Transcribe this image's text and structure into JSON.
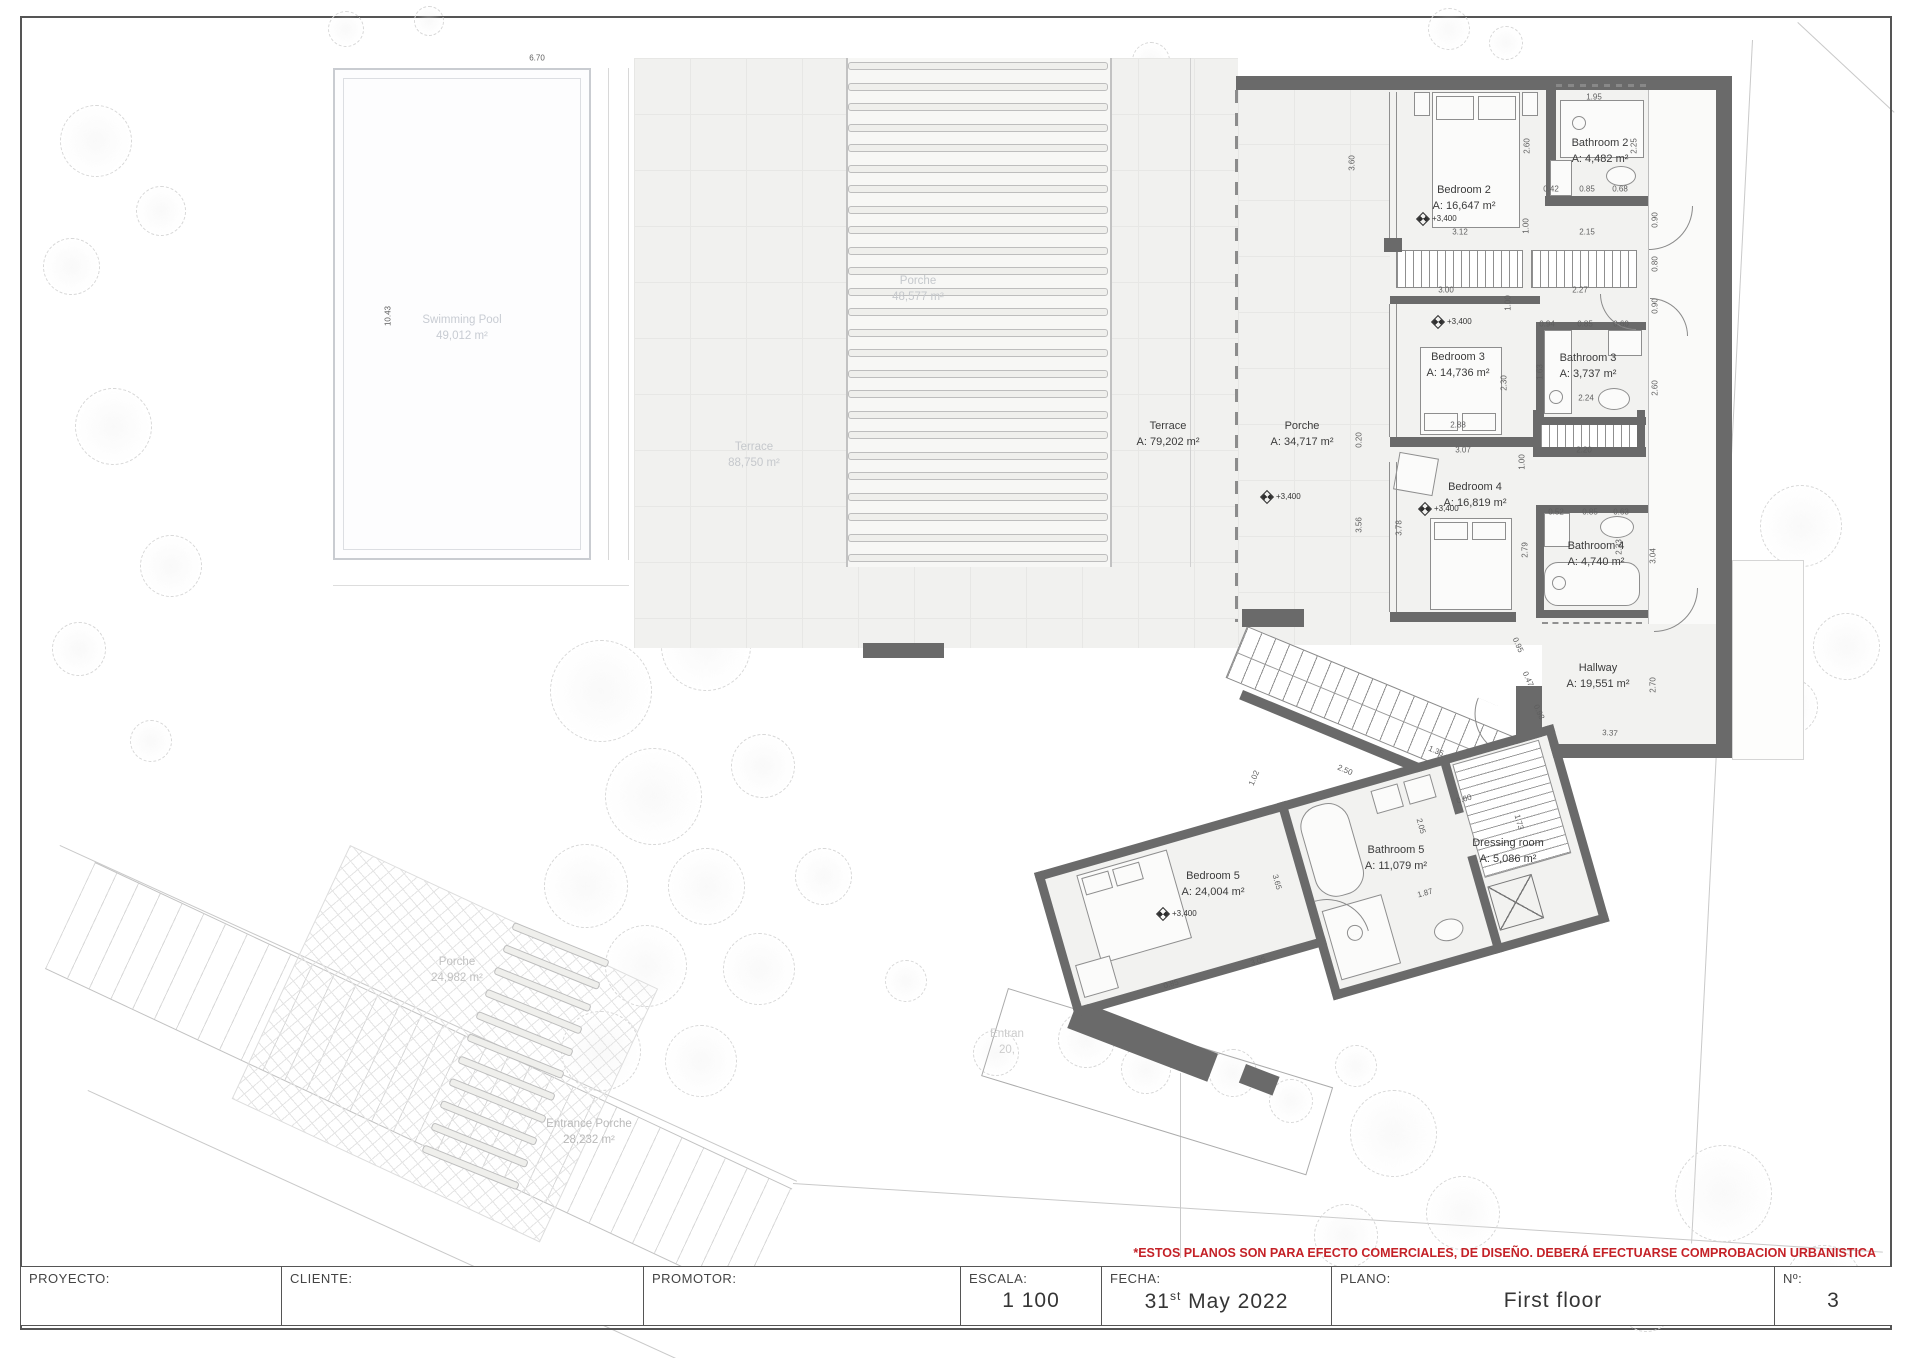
{
  "labels": {
    "plan": [
      {
        "name": "Bedroom 2",
        "area": "A: 16,647 m²"
      },
      {
        "name": "Bathroom 2",
        "area": "A: 4,482 m²"
      },
      {
        "name": "Bedroom 3",
        "area": "A: 14,736 m²"
      },
      {
        "name": "Bathroom 3",
        "area": "A: 3,737 m²"
      },
      {
        "name": "Bedroom 4",
        "area": "A: 16,819 m²"
      },
      {
        "name": "Bathroom 4",
        "area": "A: 4,740 m²"
      },
      {
        "name": "Hallway",
        "area": "A: 19,551 m²"
      },
      {
        "name": "Bedroom 5",
        "area": "A: 24,004 m²"
      },
      {
        "name": "Bathroom 5",
        "area": "A: 11,079 m²"
      },
      {
        "name": "Dressing room",
        "area": "A: 5,086 m²"
      },
      {
        "name": "Terrace",
        "area": "A: 79,202 m²"
      },
      {
        "name": "Porche",
        "area": "A: 34,717 m²"
      }
    ],
    "site": [
      {
        "name": "Swimming Pool",
        "area": "49,012 m²"
      },
      {
        "name": "Terrace",
        "area": "88,750 m²"
      },
      {
        "name": "Porche",
        "area": "48,577 m²"
      },
      {
        "name": "Entrance Porche",
        "area": "28,232 m²"
      },
      {
        "name": "Porche",
        "area": "24,982 m²"
      },
      {
        "name": "Entran",
        "area": "20,"
      }
    ]
  },
  "level_marker": {
    "text": "+3,400",
    "positions": [
      {
        "x": 1418,
        "y": 215
      },
      {
        "x": 1433,
        "y": 318
      },
      {
        "x": 1420,
        "y": 505
      },
      {
        "x": 1262,
        "y": 493
      },
      {
        "x": 1158,
        "y": 910
      }
    ]
  },
  "dims": [
    {
      "t": "6.70",
      "x": 537,
      "y": 58,
      "r": 0
    },
    {
      "t": "10.43",
      "x": 388,
      "y": 316,
      "r": -90
    },
    {
      "t": "3.60",
      "x": 1352,
      "y": 163,
      "r": -90
    },
    {
      "t": "1.95",
      "x": 1594,
      "y": 97,
      "r": 0
    },
    {
      "t": "2.60",
      "x": 1527,
      "y": 146,
      "r": -90
    },
    {
      "t": "2.25",
      "x": 1634,
      "y": 146,
      "r": -90
    },
    {
      "t": "0.42",
      "x": 1551,
      "y": 189,
      "r": 0
    },
    {
      "t": "0.85",
      "x": 1587,
      "y": 189,
      "r": 0
    },
    {
      "t": "0.68",
      "x": 1620,
      "y": 189,
      "r": 0
    },
    {
      "t": "1.00",
      "x": 1526,
      "y": 226,
      "r": -90
    },
    {
      "t": "3.12",
      "x": 1460,
      "y": 232,
      "r": 0
    },
    {
      "t": "2.15",
      "x": 1587,
      "y": 232,
      "r": 0
    },
    {
      "t": "0.90",
      "x": 1655,
      "y": 220,
      "r": -90
    },
    {
      "t": "0.80",
      "x": 1655,
      "y": 264,
      "r": -90
    },
    {
      "t": "3.00",
      "x": 1446,
      "y": 290,
      "r": 0
    },
    {
      "t": "2.27",
      "x": 1580,
      "y": 290,
      "r": 0
    },
    {
      "t": "1.00",
      "x": 1508,
      "y": 303,
      "r": -90
    },
    {
      "t": "0.94",
      "x": 1547,
      "y": 324,
      "r": 0
    },
    {
      "t": "0.85",
      "x": 1585,
      "y": 324,
      "r": 0
    },
    {
      "t": "0.60",
      "x": 1621,
      "y": 324,
      "r": 0
    },
    {
      "t": "1.63",
      "x": 1540,
      "y": 372,
      "r": -90
    },
    {
      "t": "2.30",
      "x": 1504,
      "y": 383,
      "r": -90
    },
    {
      "t": "2.24",
      "x": 1586,
      "y": 398,
      "r": 0
    },
    {
      "t": "2.88",
      "x": 1458,
      "y": 425,
      "r": 0
    },
    {
      "t": "0.90",
      "x": 1655,
      "y": 306,
      "r": -90
    },
    {
      "t": "2.60",
      "x": 1655,
      "y": 388,
      "r": -90
    },
    {
      "t": "3.07",
      "x": 1463,
      "y": 450,
      "r": 0
    },
    {
      "t": "2.20",
      "x": 1584,
      "y": 450,
      "r": 0
    },
    {
      "t": "1.00",
      "x": 1522,
      "y": 462,
      "r": -90
    },
    {
      "t": "0.52",
      "x": 1556,
      "y": 512,
      "r": 0
    },
    {
      "t": "0.85",
      "x": 1590,
      "y": 512,
      "r": 0
    },
    {
      "t": "0.63",
      "x": 1621,
      "y": 512,
      "r": 0
    },
    {
      "t": "2.79",
      "x": 1525,
      "y": 550,
      "r": -90
    },
    {
      "t": "2.33",
      "x": 1619,
      "y": 547,
      "r": -90
    },
    {
      "t": "3.04",
      "x": 1653,
      "y": 556,
      "r": -90
    },
    {
      "t": "0.20",
      "x": 1359,
      "y": 440,
      "r": -90
    },
    {
      "t": "3.56",
      "x": 1359,
      "y": 525,
      "r": -90
    },
    {
      "t": "3.78",
      "x": 1399,
      "y": 528,
      "r": -90
    },
    {
      "t": "2.70",
      "x": 1653,
      "y": 685,
      "r": -90
    },
    {
      "t": "3.37",
      "x": 1610,
      "y": 733,
      "r": 4
    },
    {
      "t": "0.95",
      "x": 1518,
      "y": 645,
      "r": 66
    },
    {
      "t": "0.47",
      "x": 1528,
      "y": 679,
      "r": 66
    },
    {
      "t": "0.98",
      "x": 1539,
      "y": 712,
      "r": 66
    },
    {
      "t": "2.50",
      "x": 1345,
      "y": 770,
      "r": 23
    },
    {
      "t": "1.35",
      "x": 1436,
      "y": 751,
      "r": 23
    },
    {
      "t": "1.02",
      "x": 1254,
      "y": 778,
      "r": -67
    },
    {
      "t": "0.60",
      "x": 1464,
      "y": 799,
      "r": -16
    },
    {
      "t": "1.73",
      "x": 1519,
      "y": 822,
      "r": 74
    },
    {
      "t": "2.05",
      "x": 1421,
      "y": 826,
      "r": 74
    },
    {
      "t": "3.65",
      "x": 1277,
      "y": 882,
      "r": 74
    },
    {
      "t": "3.05",
      "x": 1258,
      "y": 961,
      "r": -16
    },
    {
      "t": "0.85",
      "x": 1171,
      "y": 984,
      "r": -16
    },
    {
      "t": "1.87",
      "x": 1425,
      "y": 893,
      "r": -16
    }
  ],
  "disclaimer": "*ESTOS PLANOS SON PARA EFECTO COMERCIALES, DE DISEÑO. DEBERÁ EFECTUARSE COMPROBACION URBANISTICA",
  "title_block": {
    "proyecto_label": "PROYECTO:",
    "cliente_label": "CLIENTE:",
    "promotor_label": "PROMOTOR:",
    "escala_label": "ESCALA:",
    "escala_value": "1 100",
    "fecha_label": "FECHA:",
    "fecha_day": "31",
    "fecha_sup": "st",
    "fecha_rest": " May 2022",
    "plano_label": "PLANO:",
    "numero_label": "Nº:",
    "plano_value": "First floor",
    "numero_value": "3"
  },
  "colors": {
    "wall_gray": "#6a6a6a",
    "disclaimer_red": "#c42127"
  }
}
